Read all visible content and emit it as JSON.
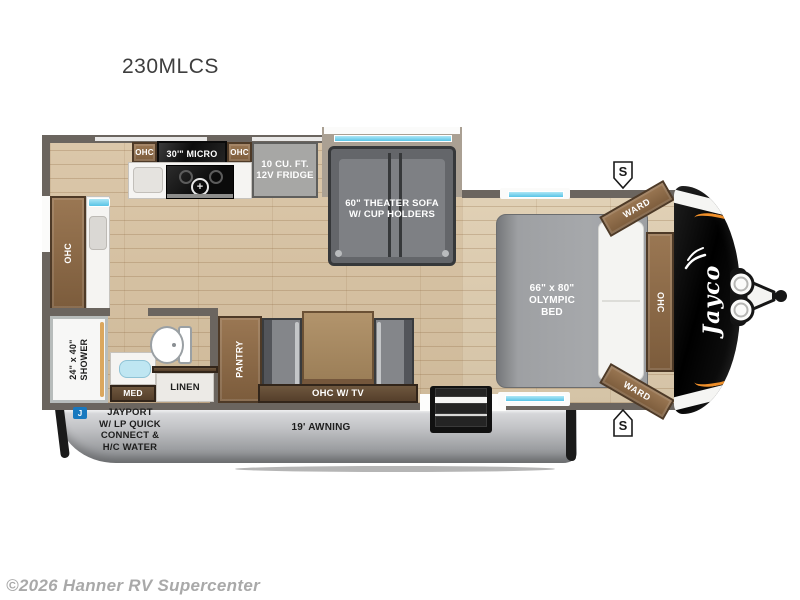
{
  "title": "230MLCS",
  "watermark": "©2026 Hanner RV Supercenter",
  "brand": {
    "logo_text": "Jayco"
  },
  "badges": {
    "speaker": "S",
    "jayport_icon": "J"
  },
  "labels": {
    "kitchen_ohc_left": "OHC",
    "microwave": "30'\" MICRO",
    "kitchen_ohc_right": "OHC",
    "fridge": "10 CU. FT.\n12V FRIDGE",
    "theater_sofa": "60\" THEATER SOFA\nW/ CUP HOLDERS",
    "rear_ohc": "OHC",
    "shower": "24\" x 40\"\nSHOWER",
    "med": "MED",
    "linen": "LINEN",
    "pantry": "PANTRY",
    "ohc_tv": "OHC W/ TV",
    "bed": "66\" x 80\"\nOLYMPIC\nBED",
    "bedroom_ohc": "OHC",
    "ward_top": "WARD",
    "ward_bottom": "WARD",
    "awning": "19' AWNING",
    "jayport": "JAYPORT\nW/ LP QUICK\nCONNECT &\nH/C WATER"
  },
  "colors": {
    "wall": "#6b655f",
    "floor": "#d7c1a0",
    "accent_orange": "#ef8f2a",
    "window_blue": "#58c4e6",
    "jayport_blue": "#1879bf",
    "cap_black": "#0d0d0d",
    "skirt_silver": "#b9babc"
  }
}
